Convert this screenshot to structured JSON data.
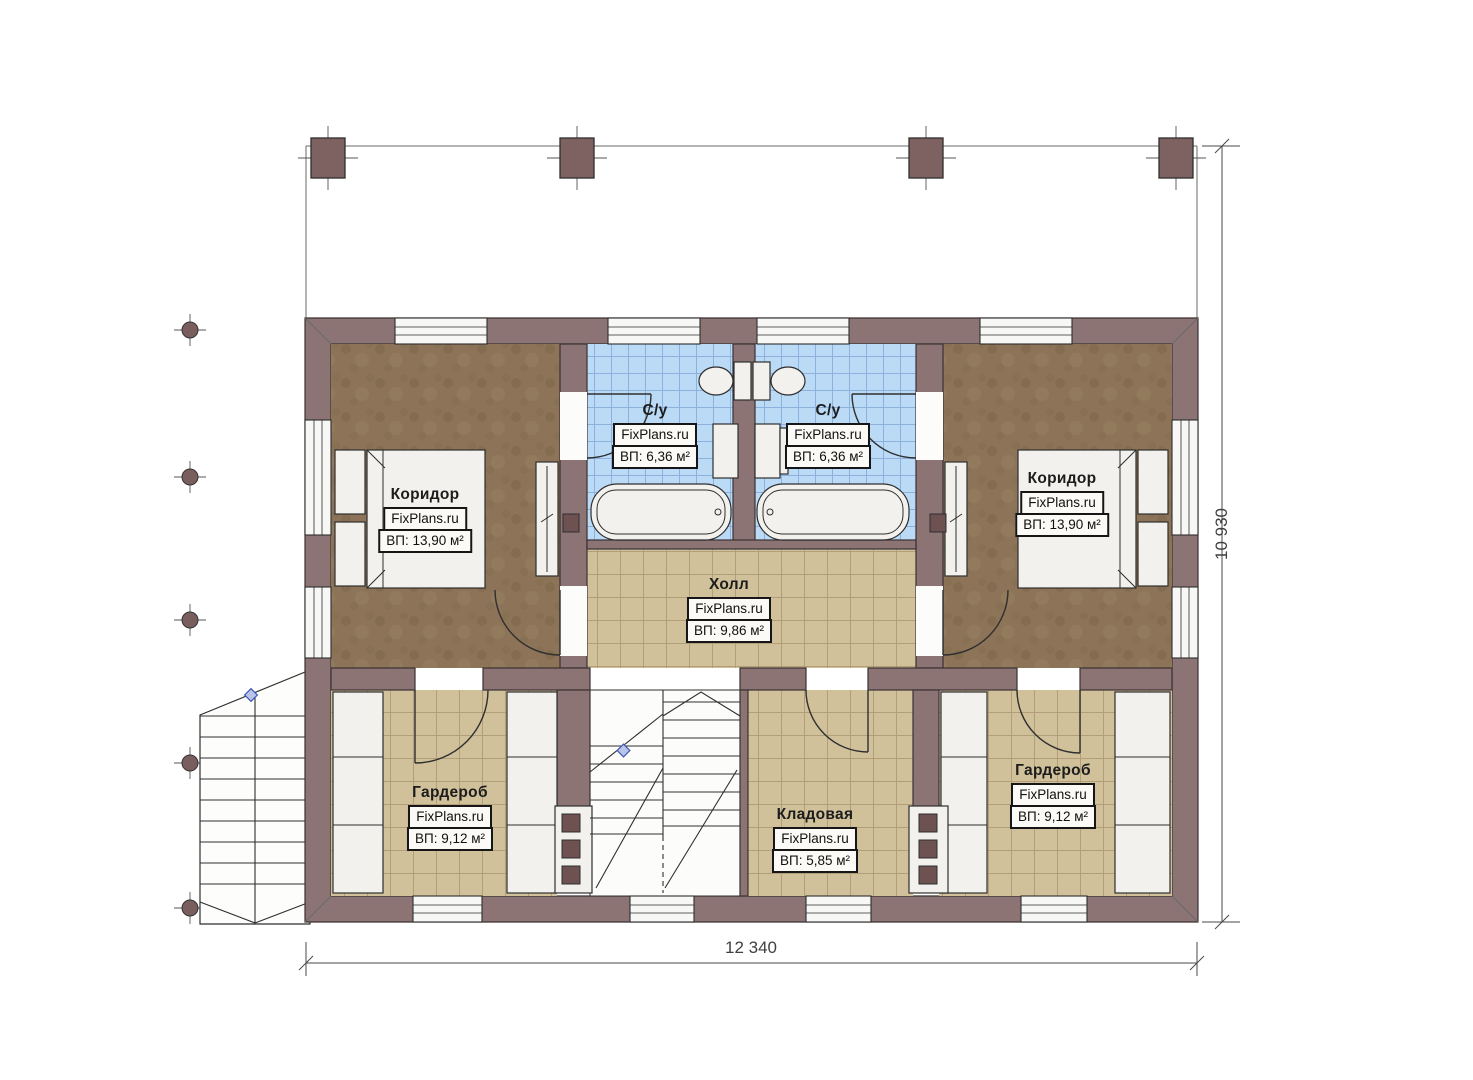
{
  "plan": {
    "title": "Floor plan (second floor)",
    "brand": "FixPlans.ru",
    "rooms": [
      {
        "id": "bathroom-left",
        "name": "С/у",
        "brand": "FixPlans.ru",
        "area": "ВП: 6,36 м²"
      },
      {
        "id": "bathroom-right",
        "name": "С/у",
        "brand": "FixPlans.ru",
        "area": "ВП: 6,36 м²"
      },
      {
        "id": "bedroom-left",
        "name": "Коридор",
        "brand": "FixPlans.ru",
        "area": "ВП: 13,90 м²"
      },
      {
        "id": "bedroom-right",
        "name": "Коридор",
        "brand": "FixPlans.ru",
        "area": "ВП: 13,90 м²"
      },
      {
        "id": "hall",
        "name": "Холл",
        "brand": "FixPlans.ru",
        "area": "ВП: 9,86 м²"
      },
      {
        "id": "wardrobe-left",
        "name": "Гардероб",
        "brand": "FixPlans.ru",
        "area": "ВП: 9,12 м²"
      },
      {
        "id": "storage",
        "name": "Кладовая",
        "brand": "FixPlans.ru",
        "area": "ВП: 5,85 м²"
      },
      {
        "id": "wardrobe-right",
        "name": "Гардероб",
        "brand": "FixPlans.ru",
        "area": "ВП: 9,12 м²"
      }
    ],
    "dimensions": {
      "width_label": "12 340",
      "height_label": "10 930"
    }
  },
  "colors": {
    "wall": "#8c7474",
    "wood_floor": "#8d7458",
    "tile_tan": "#d0c19b",
    "tile_blue": "#badaf5",
    "fixture": "#f2f1ee"
  }
}
